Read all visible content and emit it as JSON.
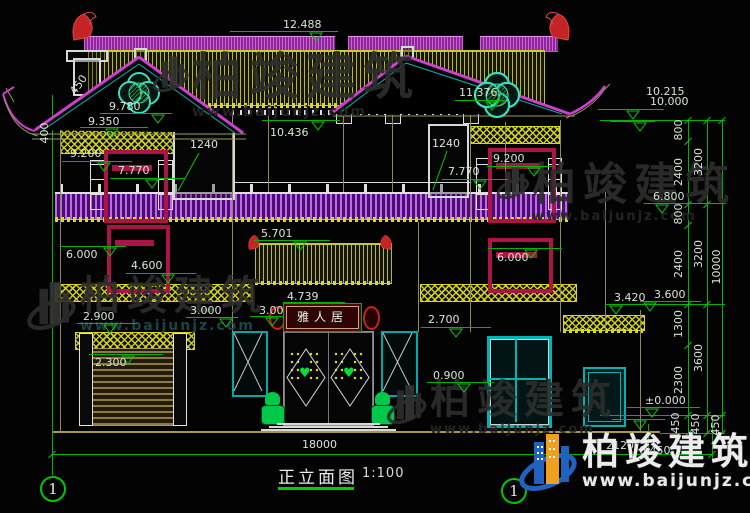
{
  "meta": {
    "title": "正立面图",
    "scale": "1:100",
    "axis_left": "1",
    "axis_right": "1"
  },
  "brand": {
    "name": "柏竣建筑",
    "url": "www.baijunjz.com"
  },
  "plaque": "雅人居",
  "colors": {
    "dim_line": "#00c800",
    "dim_text": "#d6e6d6",
    "ridge_magenta": "#c050c8",
    "roof_yellow": "#caca28",
    "tile_purple": "#8a2898",
    "window_crimson": "#aa1545",
    "teal": "#00b2b2",
    "ornament_red": "#cc2828",
    "stone_green": "#00c848",
    "logo_blue": "#1f62c0",
    "logo_orange": "#f0a020"
  },
  "elevation_markers": [
    [
      "12.488",
      283,
      19,
      230,
      338,
      31,
      316
    ],
    [
      "10.436",
      270,
      127,
      262,
      340,
      120,
      318
    ],
    [
      "11.376",
      459,
      87,
      455,
      505,
      100,
      492
    ],
    [
      "9.780",
      109,
      101,
      100,
      172,
      113,
      158
    ],
    [
      "9.350",
      88,
      116,
      80,
      148,
      127,
      112
    ],
    [
      "9.200",
      70,
      148,
      62,
      132,
      161,
      104
    ],
    [
      "7.770",
      118,
      165,
      110,
      185,
      178,
      152
    ],
    [
      "9.200",
      493,
      153,
      487,
      552,
      166,
      534
    ],
    [
      "7.770",
      448,
      166,
      442,
      508,
      179,
      480
    ],
    [
      "6.000",
      66,
      249,
      60,
      126,
      246,
      110
    ],
    [
      "4.600",
      131,
      260,
      126,
      196,
      273,
      168
    ],
    [
      "6.000",
      497,
      252,
      488,
      562,
      248,
      531
    ],
    [
      "5.701",
      261,
      228,
      254,
      330,
      240,
      300
    ],
    [
      "4.739",
      287,
      291,
      283,
      345,
      302,
      315
    ],
    [
      "3.000",
      259,
      305,
      250,
      290,
      316,
      272
    ],
    [
      "3.000",
      190,
      305,
      186,
      238,
      317,
      226
    ],
    [
      "2.900",
      83,
      311,
      77,
      137,
      323,
      110
    ],
    [
      "2.300",
      95,
      357,
      89,
      163,
      354,
      128
    ],
    [
      "2.700",
      428,
      314,
      421,
      491,
      327,
      456
    ],
    [
      "0.900",
      433,
      370,
      427,
      494,
      382,
      464
    ],
    [
      "3.420",
      614,
      292,
      605,
      648,
      304,
      616
    ],
    [
      "3.600",
      654,
      289,
      640,
      701,
      301,
      650
    ],
    [
      "6.800",
      653,
      191,
      644,
      726,
      203,
      662
    ],
    [
      "10.215",
      646,
      86,
      598,
      664,
      109,
      633
    ],
    [
      "10.000",
      650,
      96,
      610,
      655,
      121,
      640
    ],
    [
      "±0.000",
      645,
      395,
      627,
      700,
      407,
      652
    ],
    [
      "",
      0,
      0,
      612,
      665,
      419,
      640
    ]
  ],
  "rotated_dims": [
    [
      "800",
      679,
      130,
      -90
    ],
    [
      "2400",
      679,
      172,
      -90
    ],
    [
      "800",
      679,
      214,
      -90
    ],
    [
      "2400",
      679,
      264,
      -90
    ],
    [
      "1300",
      679,
      324,
      -90
    ],
    [
      "2300",
      679,
      380,
      -90
    ],
    [
      "450",
      676,
      423,
      -90
    ],
    [
      "3200",
      699,
      162,
      -90
    ],
    [
      "3200",
      699,
      254,
      -90
    ],
    [
      "3600",
      699,
      358,
      -90
    ],
    [
      "450",
      696,
      424,
      -90
    ],
    [
      "10000",
      717,
      267,
      -90
    ],
    [
      "450",
      716,
      425,
      -90
    ],
    [
      "400",
      45,
      133,
      -90
    ],
    [
      "450",
      79,
      85,
      -55
    ]
  ],
  "plain_dims": [
    [
      "18000",
      302,
      439
    ],
    [
      "2120",
      606,
      440
    ],
    [
      "0.450",
      639,
      445
    ],
    [
      "1240",
      190,
      139
    ],
    [
      "1240",
      432,
      138
    ]
  ]
}
